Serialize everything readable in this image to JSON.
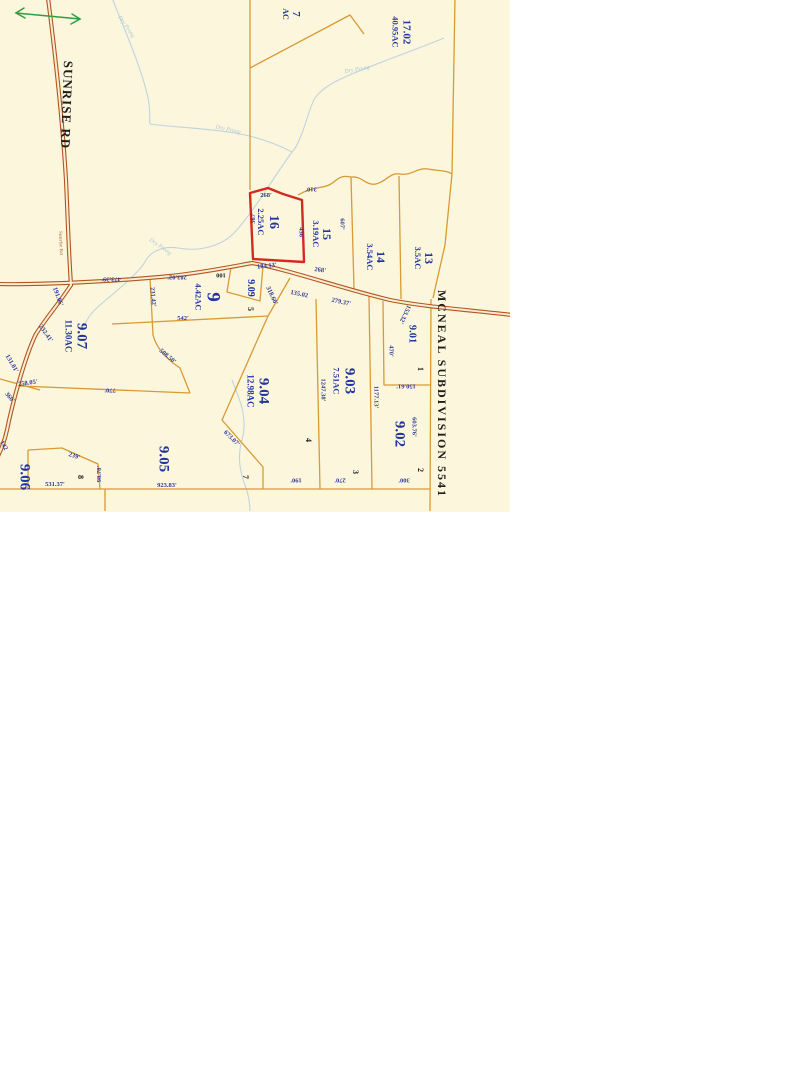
{
  "page": {
    "background": "#ffffff"
  },
  "map": {
    "background": "#fcf6dd",
    "colors": {
      "parcel_line": "#d89a33",
      "road_casing": "#b5541f",
      "road_fill": "#f8eed2",
      "highlight_outline": "#d42a1e",
      "parcel_text": "#22369e",
      "dimension_text": "#2e3a96",
      "black_text": "#1d1d1d",
      "creek": "#b6cede",
      "creek_text": "#9fc3d4",
      "arrow": "#2f9e44"
    },
    "road_labels": [
      {
        "name": "sunrise-rd-label",
        "text": "SUNRISE RD",
        "x": 67,
        "y": 105,
        "rot": 92,
        "size": 13,
        "ls": 1,
        "color": "#1d1d1d"
      },
      {
        "name": "sunrise-rd-small-label",
        "text": "Sunrise Rd",
        "x": 60,
        "y": 243,
        "rot": 88,
        "size": 5,
        "color": "#a05a28",
        "op": 0.65
      },
      {
        "name": "mcneal-subdivision-label",
        "text": "MCNEAL SUBDIVISION 5541",
        "x": 442,
        "y": 394,
        "rot": 90,
        "size": 12,
        "ls": 2,
        "color": "#1d1d1d"
      }
    ],
    "parcel_labels": [
      {
        "name": "parcel-16",
        "lines": [
          "16",
          "2.25AC"
        ],
        "x": 268,
        "y": 222,
        "rot": 90,
        "size": 14,
        "size2": 8.5
      },
      {
        "name": "parcel-15",
        "lines": [
          "15",
          "3.19AC"
        ],
        "x": 322,
        "y": 234,
        "rot": 90,
        "size": 12,
        "size2": 8.5
      },
      {
        "name": "parcel-14",
        "lines": [
          "14",
          "3.54AC"
        ],
        "x": 376,
        "y": 257,
        "rot": 90,
        "size": 12,
        "size2": 8.5
      },
      {
        "name": "parcel-13",
        "lines": [
          "13",
          "3.5AC"
        ],
        "x": 424,
        "y": 258,
        "rot": 90,
        "size": 12,
        "size2": 8.5
      },
      {
        "name": "parcel-17-02",
        "lines": [
          "17.02",
          "40.95AC"
        ],
        "x": 401,
        "y": 32,
        "rot": 90,
        "size": 11,
        "size2": 8.5
      },
      {
        "name": "parcel-7",
        "lines": [
          "7",
          "AC"
        ],
        "x": 291,
        "y": 14,
        "rot": 90,
        "size": 11,
        "size2": 8
      },
      {
        "name": "parcel-9-07",
        "lines": [
          "9.07",
          "11.30AC"
        ],
        "x": 76,
        "y": 336,
        "rot": 90,
        "size": 15,
        "size2": 9
      },
      {
        "name": "parcel-9",
        "lines": [
          "9",
          "4.42AC"
        ],
        "x": 208,
        "y": 297,
        "rot": 90,
        "size": 19,
        "size2": 8.5
      },
      {
        "name": "parcel-9-09",
        "lines": [
          "9.09"
        ],
        "x": 250,
        "y": 288,
        "rot": 90,
        "size": 10
      },
      {
        "name": "parcel-9-04",
        "lines": [
          "9.04",
          "12.98AC"
        ],
        "x": 258,
        "y": 391,
        "rot": 90,
        "size": 15,
        "size2": 9
      },
      {
        "name": "parcel-9-03",
        "lines": [
          "9.03",
          "7.51AC"
        ],
        "x": 344,
        "y": 381,
        "rot": 90,
        "size": 15,
        "size2": 8.5
      },
      {
        "name": "parcel-9-02",
        "lines": [
          "9.02"
        ],
        "x": 399,
        "y": 434,
        "rot": 90,
        "size": 15
      },
      {
        "name": "parcel-9-01",
        "lines": [
          "9.01"
        ],
        "x": 411,
        "y": 334,
        "rot": 90,
        "size": 10.5
      },
      {
        "name": "parcel-9-05",
        "lines": [
          "9.05"
        ],
        "x": 163,
        "y": 459,
        "rot": 90,
        "size": 15
      },
      {
        "name": "parcel-9-06",
        "lines": [
          "9.06"
        ],
        "x": 24,
        "y": 477,
        "rot": 90,
        "size": 15
      }
    ],
    "lot_numbers": [
      {
        "text": "5",
        "x": 250,
        "y": 309,
        "rot": 90
      },
      {
        "text": "4",
        "x": 308,
        "y": 440,
        "rot": 90
      },
      {
        "text": "3",
        "x": 355,
        "y": 472,
        "rot": 90
      },
      {
        "text": "2",
        "x": 420,
        "y": 470,
        "rot": 90
      },
      {
        "text": "1",
        "x": 420,
        "y": 369,
        "rot": 90
      },
      {
        "text": "7",
        "x": 245,
        "y": 477,
        "rot": 90
      },
      {
        "text": "8",
        "x": 80,
        "y": 477,
        "rot": 90
      }
    ],
    "dimensions": [
      {
        "text": "268'",
        "x": 266,
        "y": 196,
        "rot": 0
      },
      {
        "text": "268'",
        "x": 320,
        "y": 271,
        "rot": 8
      },
      {
        "text": "184.13'",
        "x": 267,
        "y": 267,
        "rot": -6
      },
      {
        "text": "135.02",
        "x": 299,
        "y": 295,
        "rot": 12
      },
      {
        "text": "279.37'",
        "x": 341,
        "y": 303,
        "rot": 12
      },
      {
        "text": "367'",
        "x": 254,
        "y": 218,
        "rot": -90
      },
      {
        "text": "436'",
        "x": 300,
        "y": 233,
        "rot": 90
      },
      {
        "text": "607'",
        "x": 341,
        "y": 224,
        "rot": 90
      },
      {
        "text": "310'",
        "x": 311,
        "y": 188,
        "rot": 180
      },
      {
        "text": "473.39'",
        "x": 111,
        "y": 278,
        "rot": 180
      },
      {
        "text": "283.02'",
        "x": 177,
        "y": 276,
        "rot": 180
      },
      {
        "text": "100",
        "x": 221,
        "y": 274,
        "rot": 180,
        "color": "#1d1d1d"
      },
      {
        "text": "191.06'",
        "x": 57,
        "y": 297,
        "rot": 70
      },
      {
        "text": "232.41'",
        "x": 45,
        "y": 334,
        "rot": 55
      },
      {
        "text": "131.01'",
        "x": 11,
        "y": 364,
        "rot": 60
      },
      {
        "text": "258.05'",
        "x": 28,
        "y": 384,
        "rot": -8
      },
      {
        "text": "360'",
        "x": 9,
        "y": 398,
        "rot": 50
      },
      {
        "text": "142",
        "x": 3,
        "y": 446,
        "rot": 60
      },
      {
        "text": "239'",
        "x": 74,
        "y": 457,
        "rot": 18
      },
      {
        "text": "98.78'",
        "x": 100,
        "y": 474,
        "rot": -90
      },
      {
        "text": "531.37'",
        "x": 55,
        "y": 485,
        "rot": 0
      },
      {
        "text": "923.83'",
        "x": 167,
        "y": 486,
        "rot": 0
      },
      {
        "text": "770'",
        "x": 110,
        "y": 389,
        "rot": 180
      },
      {
        "text": "508.50'",
        "x": 167,
        "y": 357,
        "rot": 40
      },
      {
        "text": "231.42'",
        "x": 152,
        "y": 297,
        "rot": 85
      },
      {
        "text": "542'",
        "x": 183,
        "y": 319,
        "rot": 0
      },
      {
        "text": "318.66'",
        "x": 271,
        "y": 296,
        "rot": 65
      },
      {
        "text": "673.07'",
        "x": 231,
        "y": 439,
        "rot": 45
      },
      {
        "text": "1247.38'",
        "x": 322,
        "y": 390,
        "rot": 90
      },
      {
        "text": "1177.13'",
        "x": 375,
        "y": 397,
        "rot": 90
      },
      {
        "text": "153.32'",
        "x": 404,
        "y": 314,
        "rot": 115
      },
      {
        "text": "470'",
        "x": 390,
        "y": 351,
        "rot": 90
      },
      {
        "text": "150.61'",
        "x": 406,
        "y": 385,
        "rot": 180
      },
      {
        "text": "603.76'",
        "x": 413,
        "y": 427,
        "rot": 90
      },
      {
        "text": "190'",
        "x": 296,
        "y": 479,
        "rot": 180
      },
      {
        "text": "270'",
        "x": 340,
        "y": 479,
        "rot": 180
      },
      {
        "text": "300'",
        "x": 404,
        "y": 479,
        "rot": 180
      }
    ],
    "creek_labels": [
      {
        "text": "Dry Prong",
        "x": 126,
        "y": 27,
        "rot": 55
      },
      {
        "text": "Dry Prong",
        "x": 228,
        "y": 130,
        "rot": 12
      },
      {
        "text": "Dry Prong",
        "x": 160,
        "y": 247,
        "rot": 35
      },
      {
        "text": "Dry Prong",
        "x": 357,
        "y": 70,
        "rot": -10
      }
    ],
    "highlight": {
      "parcel": "16",
      "acreage": "2.25AC"
    }
  }
}
